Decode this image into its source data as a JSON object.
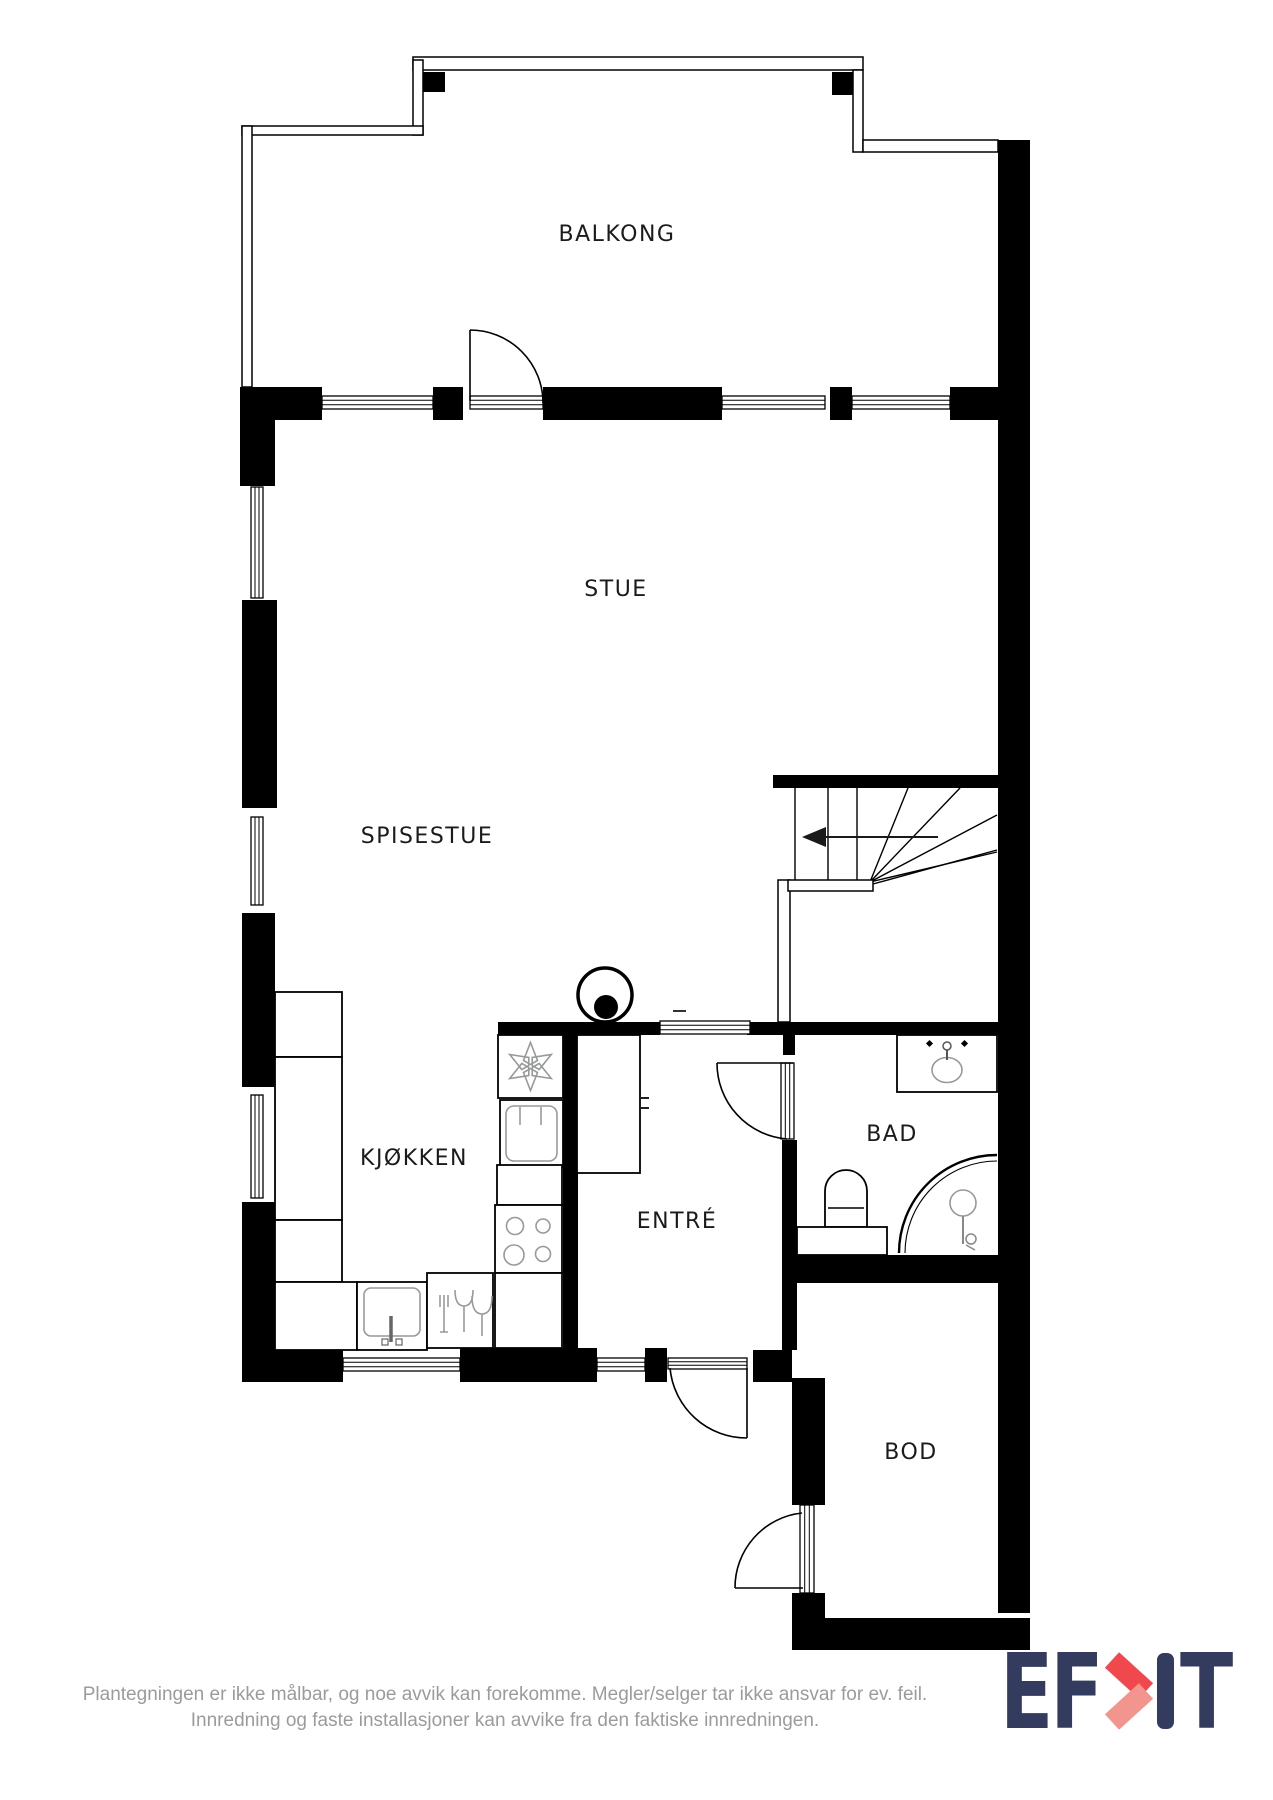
{
  "plan": {
    "rooms": [
      {
        "id": "balkong",
        "label": "BALKONG"
      },
      {
        "id": "stue",
        "label": "STUE"
      },
      {
        "id": "spisestue",
        "label": "SPISESTUE"
      },
      {
        "id": "kjokken",
        "label": "KJØKKEN"
      },
      {
        "id": "entre",
        "label": "ENTRÉ"
      },
      {
        "id": "bad",
        "label": "BAD"
      },
      {
        "id": "bod",
        "label": "BOD"
      }
    ],
    "fixtures": [
      "stairs-up-arrow",
      "water-heater",
      "ventilation-fan",
      "oven",
      "cooktop",
      "kitchen-sink",
      "dishwasher",
      "tall-cabinet",
      "bathroom-sink",
      "toilet",
      "shower"
    ]
  },
  "footer": {
    "disclaimer_line1": "Plantegningen er ikke målbar, og noe avvik kan forekomme. Megler/selger tar ikke ansvar for ev. feil.",
    "disclaimer_line2": "Innredning og faste installasjoner kan avvike fra den faktiske innredningen."
  },
  "logo": {
    "prefix": "EF",
    "suffix": "T"
  },
  "colors": {
    "plan_black": "#000000",
    "fixture_gray": "#98999b",
    "disclaimer_gray": "#9B9B9B",
    "logo_navy": "#333B5F",
    "logo_red": "#F0484C",
    "logo_red_light": "#F2958E"
  }
}
